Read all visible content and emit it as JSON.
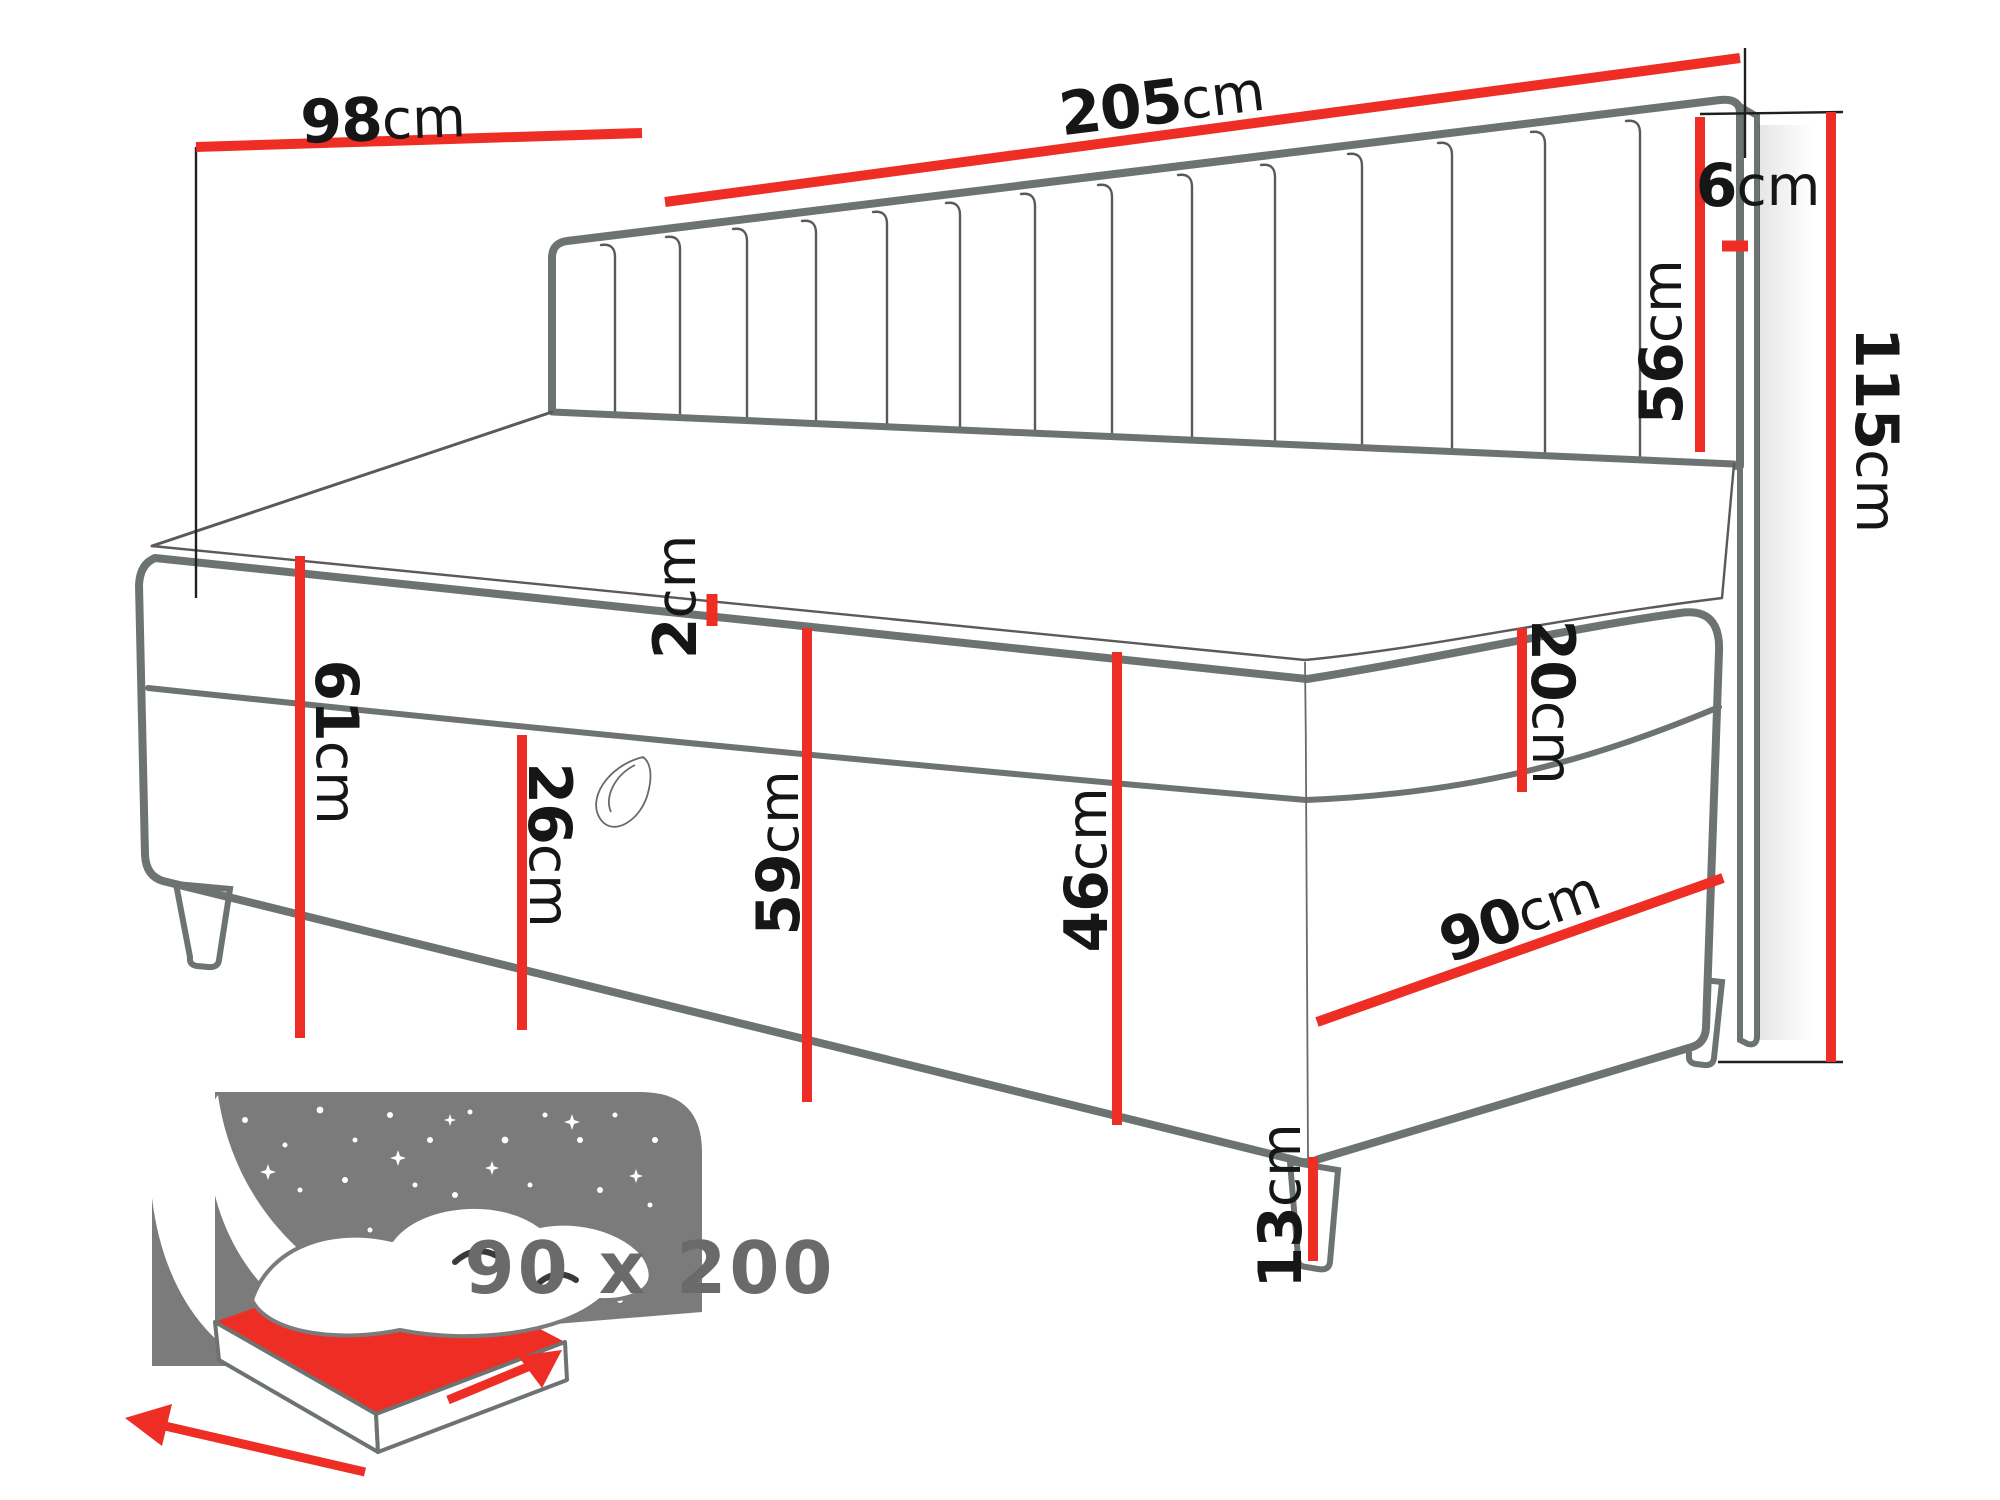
{
  "diagram": {
    "type": "bed-dimension-diagram",
    "dimensions": {
      "depth_98": {
        "value": "98",
        "unit": "cm"
      },
      "width_205": {
        "value": "205",
        "unit": "cm"
      },
      "headboard_side_6": {
        "value": "6",
        "unit": "cm"
      },
      "headboard_height_56": {
        "value": "56",
        "unit": "cm"
      },
      "total_height_115": {
        "value": "115",
        "unit": "cm"
      },
      "topper_2": {
        "value": "2",
        "unit": "cm"
      },
      "left_height_61": {
        "value": "61",
        "unit": "cm"
      },
      "storage_26": {
        "value": "26",
        "unit": "cm"
      },
      "front_height_59": {
        "value": "59",
        "unit": "cm"
      },
      "side_height_46": {
        "value": "46",
        "unit": "cm"
      },
      "mattress_20": {
        "value": "20",
        "unit": "cm"
      },
      "width_90": {
        "value": "90",
        "unit": "cm"
      },
      "leg_13": {
        "value": "13",
        "unit": "cm"
      }
    },
    "size_badge": {
      "label": "90 x 200"
    }
  },
  "colors": {
    "accent": "#ee2e24",
    "outline": "#6d7372",
    "seam": "#5a5a5a",
    "panel": "#7b7b7b",
    "ink": "#161616",
    "muted": "#6a6a6a",
    "extension": "#1f1f1f"
  }
}
